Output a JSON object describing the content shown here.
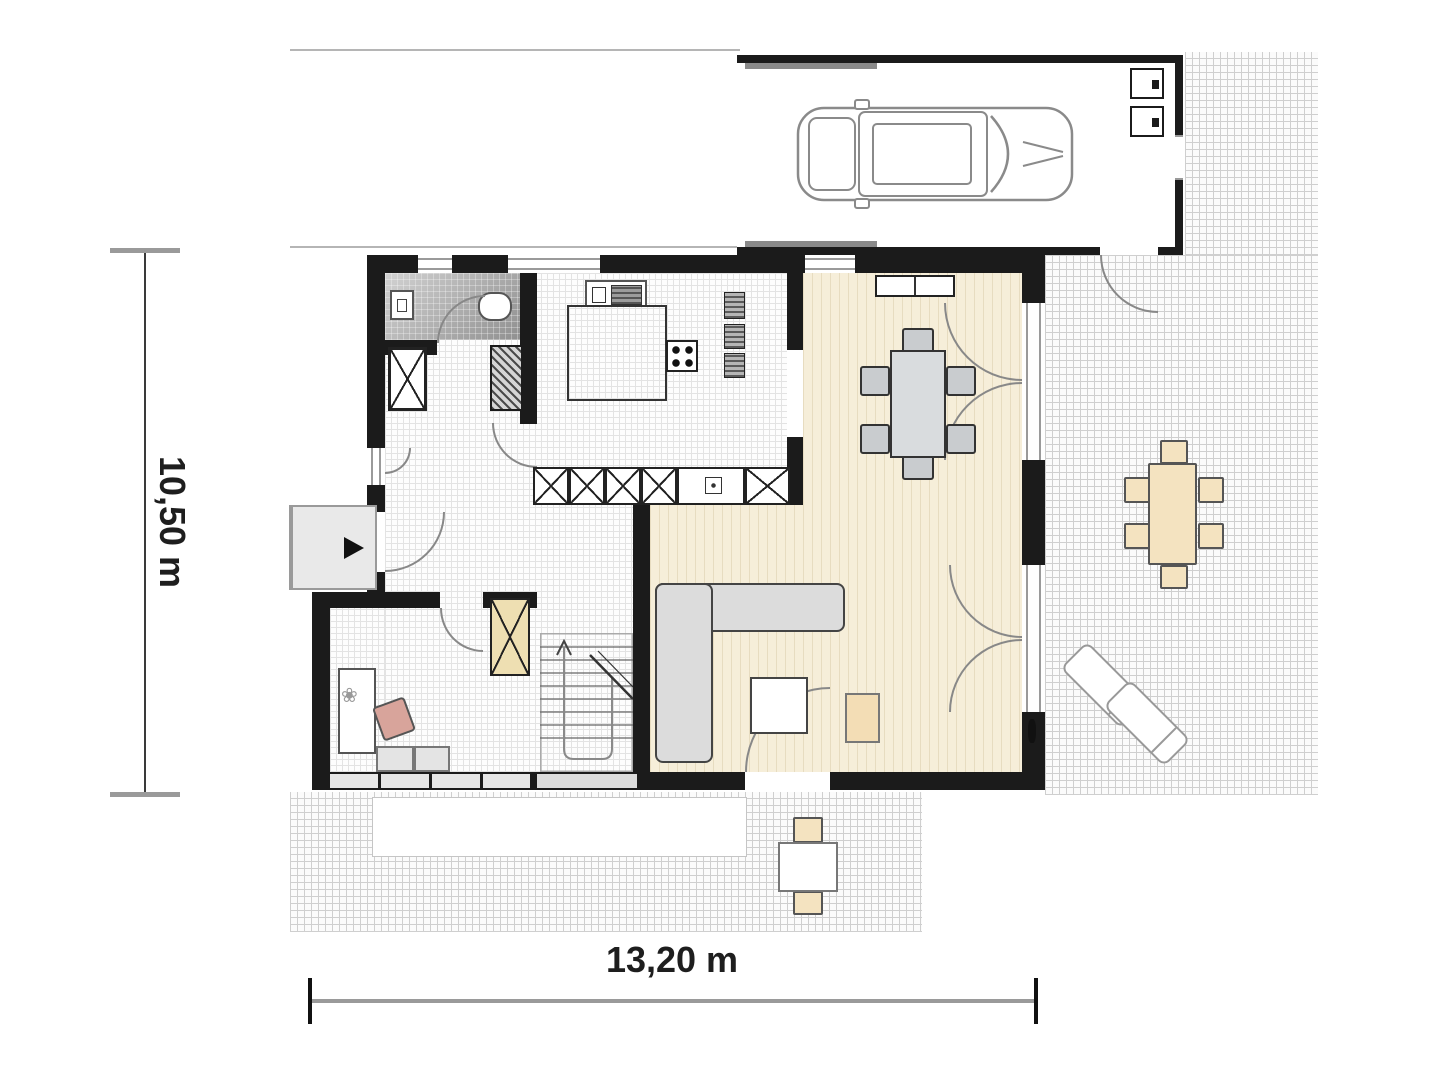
{
  "document": {
    "type": "architectural floor plan, ground floor with garage and terraces"
  },
  "dimension_annotations": {
    "vertical": "10,50 m",
    "horizontal": "13,20 m"
  },
  "icons": {
    "flower": "❀"
  },
  "palette": {
    "wall": "#1b1b1b",
    "wood_floor": "#f6eed9",
    "wood_stripe": "#e7dcc0",
    "tile_grid_line": "#e3e3e3",
    "terrace_grid_line": "#cfcfcf",
    "sofa_gray": "#dcdcdc",
    "table_gray": "#d9dcde",
    "furniture_beige": "#f4e3c0",
    "chimney_beige": "#eedfb2",
    "office_chair_pink": "#d8a49b",
    "dimension_text": "#1e1e1e"
  },
  "depicted_elements": [
    "garage with car and two appliances",
    "driveway",
    "entrance porch with arrow",
    "wc with sink and toilet",
    "kitchen with island, sink, cooktop and cabinets",
    "dining room with table and six chairs",
    "living room with corner sofa, coffee table and pouf",
    "office with desk and chair",
    "staircase",
    "chimney shafts",
    "right terrace with dining table and two loungers",
    "bottom terrace with small table and two chairs",
    "french doors to terrace",
    "dimension lines"
  ]
}
